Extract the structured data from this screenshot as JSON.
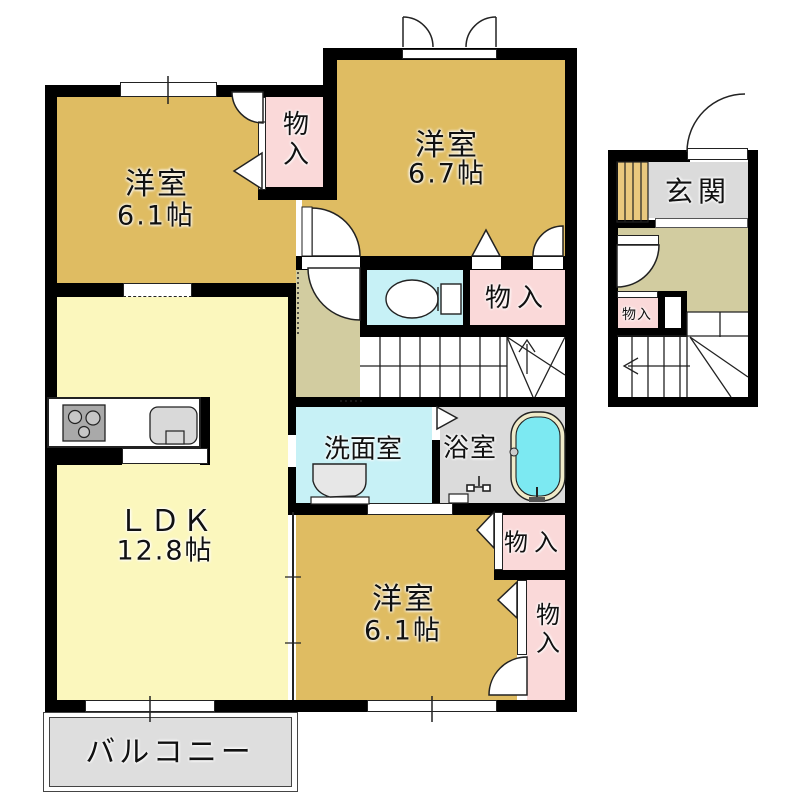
{
  "floorplan": {
    "rooms": {
      "bedroom_top_left": {
        "name": "洋室",
        "size": "6.1帖"
      },
      "bedroom_top_right": {
        "name": "洋室",
        "size": "6.7帖"
      },
      "ldk": {
        "name": "ＬＤＫ",
        "size": "12.8帖"
      },
      "washroom": {
        "name": "洗面室"
      },
      "bathroom": {
        "name": "浴室"
      },
      "bedroom_bottom": {
        "name": "洋室",
        "size": "6.1帖"
      },
      "entrance": {
        "name": "玄関"
      },
      "balcony": {
        "name": "バルコニー"
      },
      "closet": {
        "name": "物入"
      }
    },
    "colors": {
      "bedroom_tan": "#DFBC62",
      "ldk_yellow": "#FBF7BD",
      "closet_pink": "#FAD9D9",
      "wet_cyan": "#C7F1F6",
      "tub_cyan": "#7CE9F2",
      "tub_rim_cream": "#EFEAC9",
      "gray_floor": "#DBDBDB",
      "hall_beige": "#D2CCA0",
      "shoe_cabinet_tan": "#E9C87E",
      "balcony_gray": "#DEDEDE",
      "wall_black": "#000000"
    }
  }
}
